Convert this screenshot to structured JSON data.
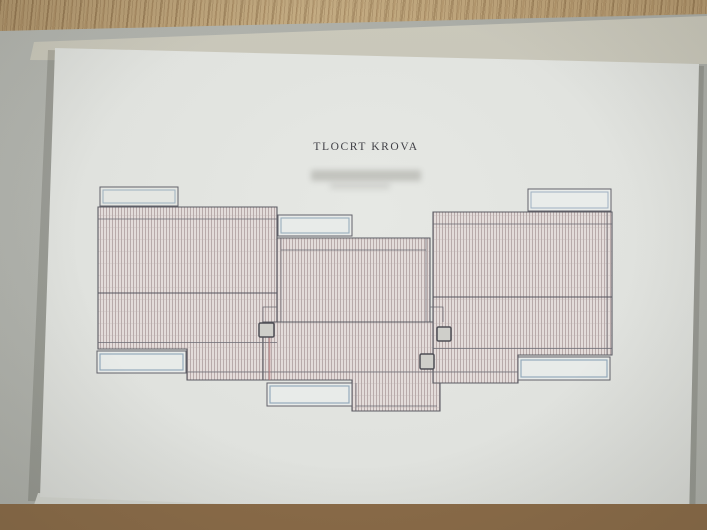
{
  "document": {
    "title": "TLOCRT KROVA"
  },
  "drawing": {
    "type": "architectural roof plan",
    "sections": [
      "left-roof-section",
      "middle-roof-section",
      "central-roof-band",
      "right-roof-section"
    ],
    "skylight_count": 6,
    "chimney_count": 3
  },
  "colors": {
    "paper": "#e0e2de",
    "underlay_grey": "#aeb0aa",
    "stack_edge": "#c6c4b7",
    "wood_top": "#b69a70",
    "wood_bottom": "#8a6b48",
    "outline": "#5b5b63",
    "hatch_line": "#a59496",
    "hatch_background": "#e3dcda",
    "skylight_fill": "#e8ebe9",
    "skylight_stroke": "#8ba3b6",
    "chimney_fill": "#cfcfca",
    "ridge_line": "#55555d",
    "red_joint_line": "#b07a7c",
    "title_text": "#3f3f45"
  }
}
